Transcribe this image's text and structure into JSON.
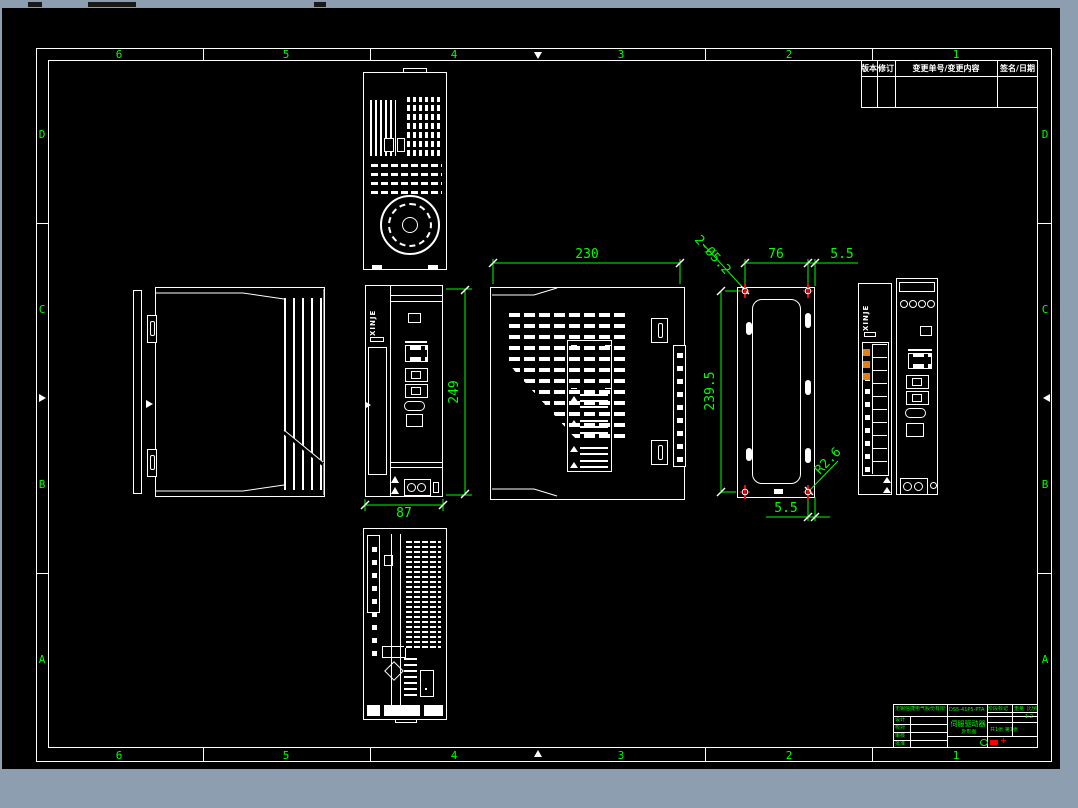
{
  "colors": {
    "background": "#8c9eb0",
    "sheet": "#000000",
    "line": "#ffffff",
    "dimension": "#00ff00",
    "center_mark": "#ff0000",
    "terminal_highlight": "#e08018"
  },
  "frame": {
    "top": [
      "6",
      "5",
      "4",
      "3",
      "2",
      "1"
    ],
    "bottom": [
      "6",
      "5",
      "4",
      "3",
      "2",
      "1"
    ],
    "left": [
      "D",
      "C",
      "B",
      "A"
    ],
    "right": [
      "D",
      "C",
      "B",
      "A"
    ]
  },
  "revision": {
    "headers": [
      "版本",
      "修订",
      "变更单号/变更内容",
      "签名/日期"
    ]
  },
  "dims": {
    "w230": "230",
    "holes": "2-Ø5.2",
    "w76": "76",
    "t55": "5.5",
    "h2395": "239.5",
    "b55": "5.5",
    "fillet": "R2.6",
    "h249": "249",
    "w87": "87"
  },
  "logo": {
    "text": "XINJE"
  },
  "title_block": {
    "company": "无锡信捷电气股份有限公司",
    "doc_no": "DS5-41P5-PTA",
    "sign_rows": [
      "设计",
      "校对",
      "审核",
      "批准"
    ],
    "product": "伺服驱动器",
    "drawing_name": "外形图",
    "stage": "阶段标记",
    "weight": "重量",
    "scale_label": "比例",
    "scale_value": "1:2",
    "sheet_info": "共1张 第1张"
  }
}
